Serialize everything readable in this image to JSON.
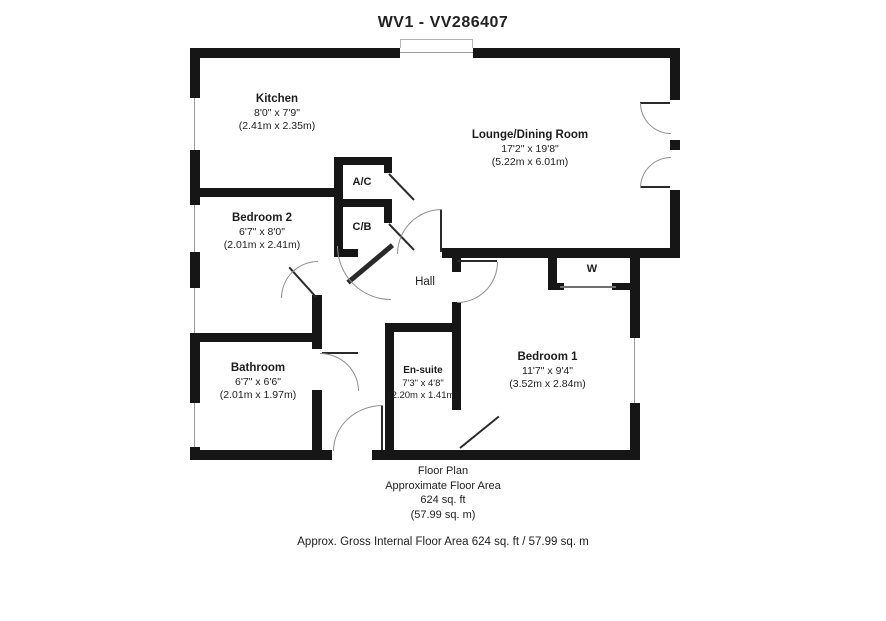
{
  "title": "WV1 - VV286407",
  "rooms": [
    {
      "name": "Kitchen",
      "imperial": "8'0\" x 7'9\"",
      "metric": "(2.41m x 2.35m)"
    },
    {
      "name": "Lounge/Dining Room",
      "imperial": "17'2\" x 19'8\"",
      "metric": "(5.22m x 6.01m)"
    },
    {
      "name": "Bedroom 2",
      "imperial": "6'7\" x 8'0\"",
      "metric": "(2.01m x 2.41m)"
    },
    {
      "name": "Bathroom",
      "imperial": "6'7\" x 6'6\"",
      "metric": "(2.01m x 1.97m)"
    },
    {
      "name": "En-suite",
      "imperial": "7'3\" x 4'8\"",
      "metric": "(2.20m x 1.41m)"
    },
    {
      "name": "Bedroom 1",
      "imperial": "11'7\" x 9'4\"",
      "metric": "(3.52m x 2.84m)"
    }
  ],
  "annotations": {
    "airing_cupboard": "A/C",
    "cupboard": "C/B",
    "hall": "Hall",
    "wardrobe": "W"
  },
  "footer": {
    "line1": "Floor Plan",
    "line2": "Approximate Floor Area",
    "line3": "624 sq. ft",
    "line4": "(57.99 sq. m)",
    "disclaimer": "Approx. Gross Internal Floor Area 624 sq. ft / 57.99 sq. m"
  },
  "colors": {
    "wall": "#161616",
    "text": "#1d1d1d",
    "door_arc": "#8f8f8f"
  }
}
